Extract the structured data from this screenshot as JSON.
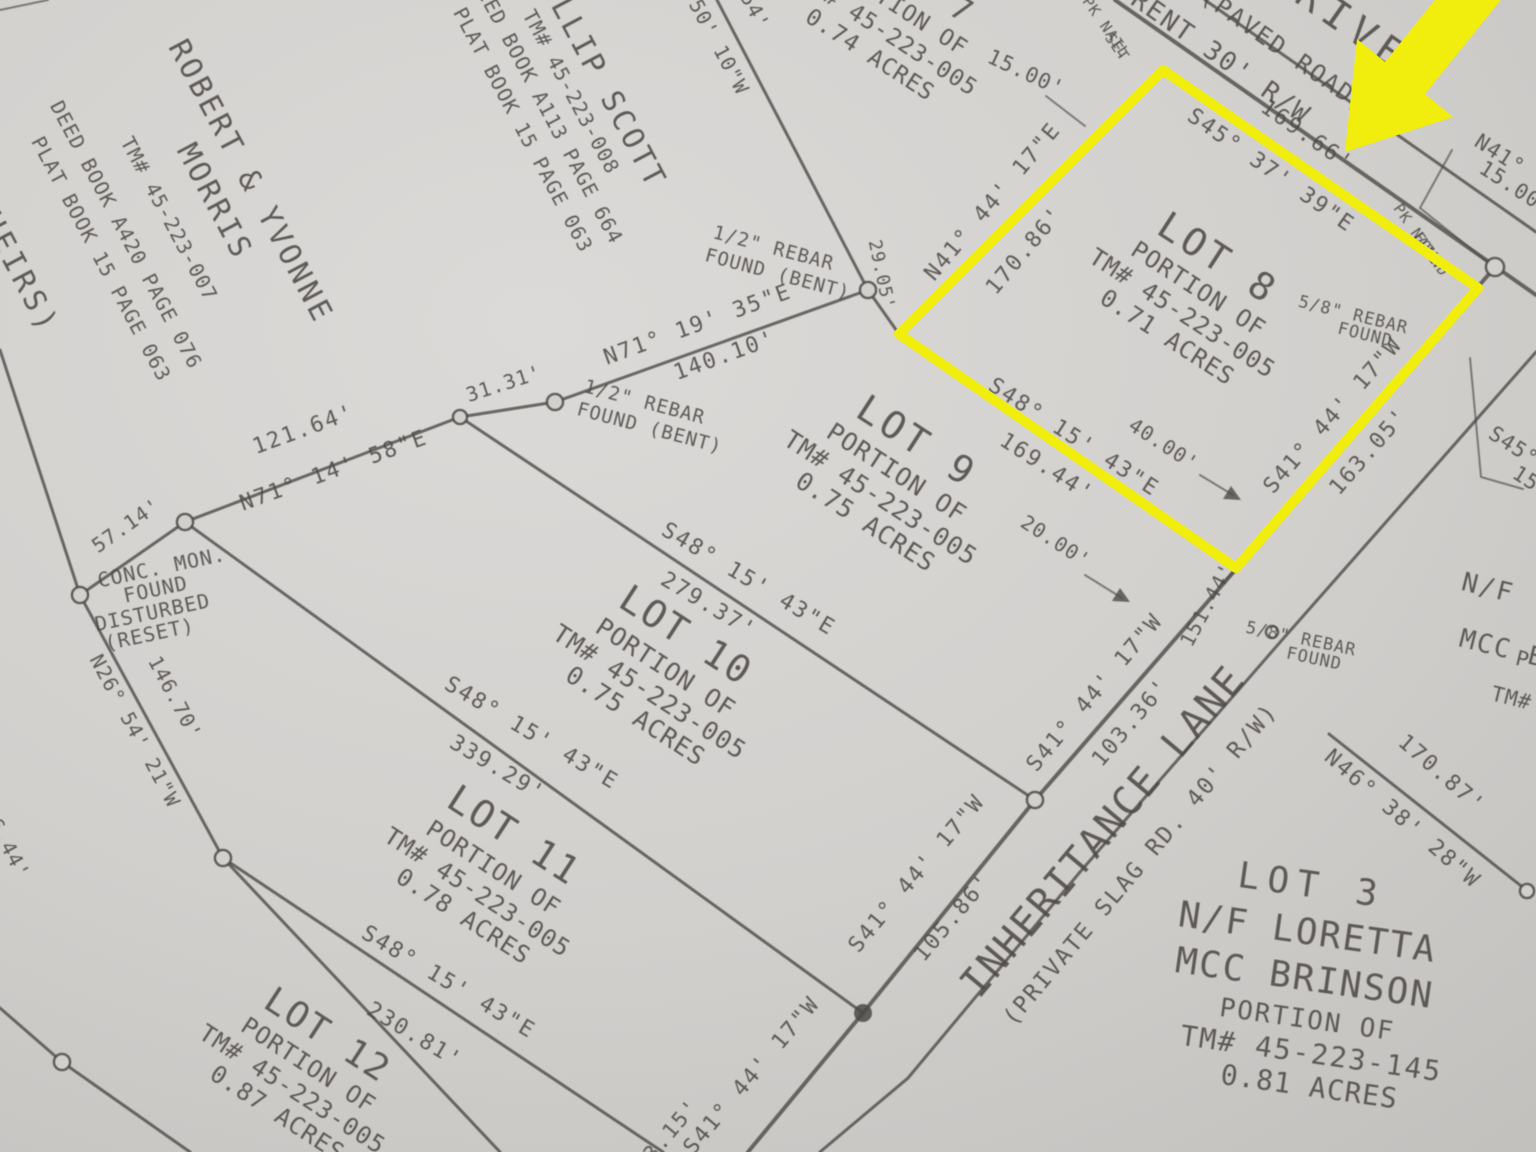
{
  "colors": {
    "ink": "#4d4a47",
    "paper_light": "#dcdad8",
    "paper_mid": "#d2d0cd",
    "paper_dark": "#c3c1be",
    "highlight": "#f1ee0d"
  },
  "highlighted_lot": "LOT 8",
  "labels": [
    {
      "id": "heirs-fragment",
      "text": "(HEIRS)"
    },
    {
      "id": "morris-owner-line1",
      "text": "ROBERT & YVONNE"
    },
    {
      "id": "morris-owner-line2",
      "text": "MORRIS"
    },
    {
      "id": "morris-tm",
      "text": "TM# 45-223-007"
    },
    {
      "id": "morris-deed",
      "text": "DEED BOOK A420 PAGE 076"
    },
    {
      "id": "morris-plat",
      "text": "PLAT BOOK 15 PAGE 063"
    },
    {
      "id": "scott-owner",
      "text": "PHILLIP SCOTT"
    },
    {
      "id": "scott-tm",
      "text": "TM# 45-223-008"
    },
    {
      "id": "scott-deed",
      "text": "DEED BOOK A113 PAGE 664"
    },
    {
      "id": "scott-plat",
      "text": "PLAT BOOK 15 PAGE 063"
    },
    {
      "id": "lot7-title",
      "text": "LOT 7"
    },
    {
      "id": "lot7-portion",
      "text": "PORTION OF"
    },
    {
      "id": "lot7-tm",
      "text": "TM# 45-223-005"
    },
    {
      "id": "lot7-acres",
      "text": "0.74 ACRES"
    },
    {
      "id": "dist-54-fragment",
      "text": "54'"
    },
    {
      "id": "bearing-5010-fragment",
      "text": "50' 10\"W"
    },
    {
      "id": "dist-1500",
      "text": "15.00'"
    },
    {
      "id": "pknail-set-line1",
      "text": "PK NAIL"
    },
    {
      "id": "pknail-set-line2",
      "text": "SET"
    },
    {
      "id": "road-name-fragment",
      "text": "DRIVE"
    },
    {
      "id": "road-paved",
      "text": "(PAVED ROAD)"
    },
    {
      "id": "road-rw-fragment",
      "text": "RENT 30' R/W"
    },
    {
      "id": "dist-16966",
      "text": "169.66'"
    },
    {
      "id": "bearing-s4537",
      "text": "S45° 37' 39\"E"
    },
    {
      "id": "pknail-found-line1",
      "text": "PK NAIL"
    },
    {
      "id": "pknail-found-line2",
      "text": "FOUND"
    },
    {
      "id": "edge-n41-fragment",
      "text": "N41°"
    },
    {
      "id": "edge-1500-fragment",
      "text": "15.00'"
    },
    {
      "id": "bearing-n4144",
      "text": "N41° 44' 17\"E"
    },
    {
      "id": "dist-17086",
      "text": "170.86'"
    },
    {
      "id": "lot8-title",
      "text": "LOT 8"
    },
    {
      "id": "lot8-portion",
      "text": "PORTION OF"
    },
    {
      "id": "lot8-tm",
      "text": "TM# 45-223-005"
    },
    {
      "id": "lot8-acres",
      "text": "0.71 ACRES"
    },
    {
      "id": "rebar58-lot8-line1",
      "text": "5/8\" REBAR"
    },
    {
      "id": "rebar58-lot8-line2",
      "text": "FOUND"
    },
    {
      "id": "bearing-s4144-1",
      "text": "S41° 44' 17\"W"
    },
    {
      "id": "dist-16305",
      "text": "163.05'"
    },
    {
      "id": "dist-2905",
      "text": "29.05'"
    },
    {
      "id": "rebar12-top-line1",
      "text": "1/2\" REBAR"
    },
    {
      "id": "rebar12-top-line2",
      "text": "FOUND (BENT)"
    },
    {
      "id": "bearing-n7119",
      "text": "N71° 19' 35\"E"
    },
    {
      "id": "dist-14010",
      "text": "140.10'"
    },
    {
      "id": "dist-3131",
      "text": "31.31'"
    },
    {
      "id": "rebar12-low-line1",
      "text": "1/2\" REBAR"
    },
    {
      "id": "rebar12-low-line2",
      "text": "FOUND (BENT)"
    },
    {
      "id": "bearing-n7114",
      "text": "N71° 14' 58\"E"
    },
    {
      "id": "dist-12164",
      "text": "121.64'"
    },
    {
      "id": "dist-5714",
      "text": "57.14'"
    },
    {
      "id": "concmon-line1",
      "text": "CONC. MON."
    },
    {
      "id": "concmon-line2",
      "text": "FOUND"
    },
    {
      "id": "concmon-line3",
      "text": "DISTURBED"
    },
    {
      "id": "concmon-line4",
      "text": "(RESET)"
    },
    {
      "id": "bearing-n2654",
      "text": "N26° 54' 21\"W"
    },
    {
      "id": "dist-14670",
      "text": "146.70'"
    },
    {
      "id": "lot9-title",
      "text": "LOT 9"
    },
    {
      "id": "lot9-portion",
      "text": "PORTION OF"
    },
    {
      "id": "lot9-tm",
      "text": "TM# 45-223-005"
    },
    {
      "id": "lot9-acres",
      "text": "0.75 ACRES"
    },
    {
      "id": "bearing-s4815-lot8",
      "text": "S48° 15' 43\"E"
    },
    {
      "id": "dist-16944",
      "text": "169.44'"
    },
    {
      "id": "dist-4000",
      "text": "40.00'"
    },
    {
      "id": "dist-2000",
      "text": "20.00'"
    },
    {
      "id": "bearing-s4815-a",
      "text": "S48° 15' 43\"E"
    },
    {
      "id": "dist-27937",
      "text": "279.37'"
    },
    {
      "id": "lot10-title",
      "text": "LOT 10"
    },
    {
      "id": "lot10-portion",
      "text": "PORTION OF"
    },
    {
      "id": "lot10-tm",
      "text": "TM# 45-223-005"
    },
    {
      "id": "lot10-acres",
      "text": "0.75 ACRES"
    },
    {
      "id": "bearing-s4815-b",
      "text": "S48° 15' 43\"E"
    },
    {
      "id": "dist-33929",
      "text": "339.29'"
    },
    {
      "id": "lot11-title",
      "text": "LOT 11"
    },
    {
      "id": "lot11-portion",
      "text": "PORTION OF"
    },
    {
      "id": "lot11-tm",
      "text": "TM# 45-223-005"
    },
    {
      "id": "lot11-acres",
      "text": "0.78 ACRES"
    },
    {
      "id": "bearing-s4815-c",
      "text": "S48° 15' 43\"E"
    },
    {
      "id": "dist-23081",
      "text": "230.81'"
    },
    {
      "id": "lot12-title",
      "text": "LOT 12"
    },
    {
      "id": "lot12-portion",
      "text": "PORTION OF"
    },
    {
      "id": "lot12-tm",
      "text": "TM# 45-223-005"
    },
    {
      "id": "lot12-acres",
      "text": "0.87 ACRES"
    },
    {
      "id": "edge-9644-fragment",
      "text": "96.44'"
    },
    {
      "id": "bearing-s4144-2",
      "text": "S41° 44' 17\"W"
    },
    {
      "id": "dist-10336",
      "text": "103.36'"
    },
    {
      "id": "lane-name",
      "text": "INHERITANCE LANE"
    },
    {
      "id": "lane-sub",
      "text": "(PRIVATE SLAG RD. 40' R/W)"
    },
    {
      "id": "bearing-s4144-3",
      "text": "S41° 44' 17\"W"
    },
    {
      "id": "dist-10586",
      "text": "105.86'"
    },
    {
      "id": "bearing-s4144-4",
      "text": "S41° 44' 17\"W"
    },
    {
      "id": "dist-9315",
      "text": "93.15'"
    },
    {
      "id": "rebar58-lane-line1",
      "text": "5/8\" REBAR"
    },
    {
      "id": "rebar58-lane-line2",
      "text": "FOUND"
    },
    {
      "id": "dist-15144",
      "text": "151.44'"
    },
    {
      "id": "bearing-n4638",
      "text": "N46° 38' 28\"W"
    },
    {
      "id": "dist-17087",
      "text": "170.87'"
    },
    {
      "id": "edge-nf-fragment",
      "text": "N/F"
    },
    {
      "id": "edge-mcc-fragment",
      "text": "MCC B"
    },
    {
      "id": "edge-p-fragment",
      "text": "P"
    },
    {
      "id": "edge-tm-fragment",
      "text": "TM# 4"
    },
    {
      "id": "lot3-title",
      "text": "LOT 3"
    },
    {
      "id": "lot3-owner1",
      "text": "N/F LORETTA"
    },
    {
      "id": "lot3-owner2",
      "text": "MCC BRINSON"
    },
    {
      "id": "lot3-portion",
      "text": "PORTION OF"
    },
    {
      "id": "lot3-tm",
      "text": "TM# 45-223-145"
    },
    {
      "id": "lot3-acres",
      "text": "0.81 ACRES"
    },
    {
      "id": "edge-s45-fragment",
      "text": "S45°"
    },
    {
      "id": "edge-150-fragment",
      "text": "150"
    }
  ]
}
